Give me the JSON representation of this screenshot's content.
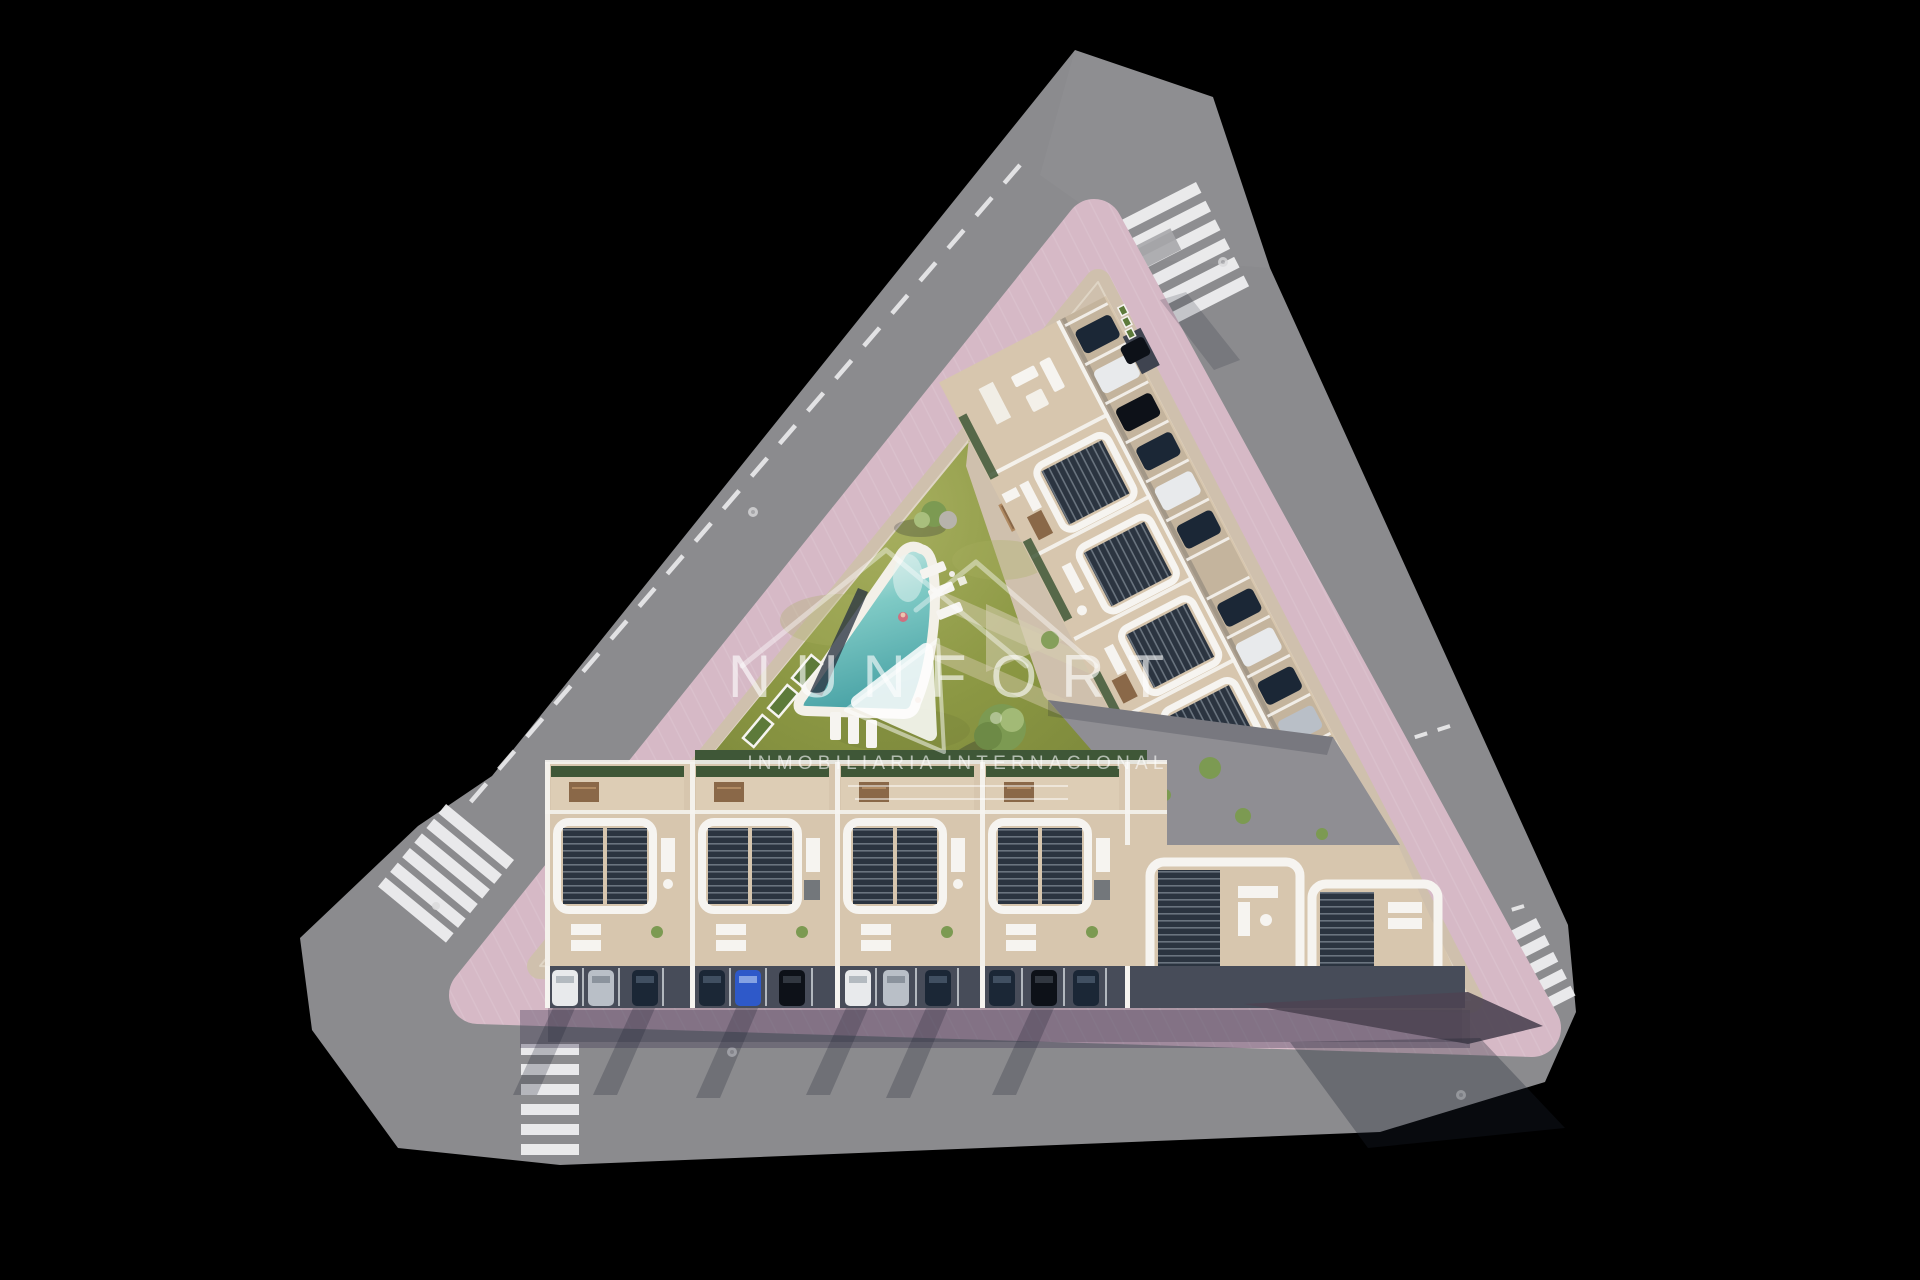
{
  "image": {
    "kind": "aerial 3d render of a triangular residential development site plan",
    "width": 1920,
    "height": 1280,
    "background": "#000000"
  },
  "watermark": {
    "brand": "NUNFORT",
    "tagline": "INMOBILIARIA INTERNACIONAL"
  },
  "colors": {
    "bg": "#000000",
    "street": "#8b8b8e",
    "marking": "#f2f2f3",
    "sidewalk": "#d6b9c6",
    "plot_base": "#cfc0ad",
    "path": "#d6cdb0",
    "lawn": "#8b9743",
    "lawn_light": "#a8b060",
    "hedge": "#3f5737",
    "tree": "#7c9a52",
    "tree_light": "#a9bf7d",
    "pool_shallow": "#e9f6f3",
    "pool_mid": "#7fcac5",
    "pool_deep": "#4aa3a6",
    "deck": "#f3f0e8",
    "wall": "#f6f4f0",
    "roof": "#d7c6ae",
    "pergola": "#2b3440",
    "slat": "#aab4bd",
    "wood": "#8a6848",
    "car_dark": "#1b2736",
    "car_black": "#0d1118",
    "car_white": "#e8eaec",
    "car_silver": "#b9bfc7",
    "car_blue": "#2e59c9",
    "asphalt_inner": "#8f8e93",
    "apron": "#4c4452",
    "planter": "#5d7a3a",
    "shadow": "#1c2130",
    "watermark": "#ffffff"
  },
  "scene": {
    "features": [
      "triangular residential block",
      "perimeter streets with zebra crossings",
      "pink paved sidewalk ring",
      "central lawn courtyard",
      "freeform swimming pool",
      "sun loungers",
      "trees and planters",
      "rooftop terraces with dark pergolas",
      "street-side parking bays with cars",
      "row houses with private garages",
      "inner paved courtyard",
      "watermark logo and text"
    ]
  }
}
